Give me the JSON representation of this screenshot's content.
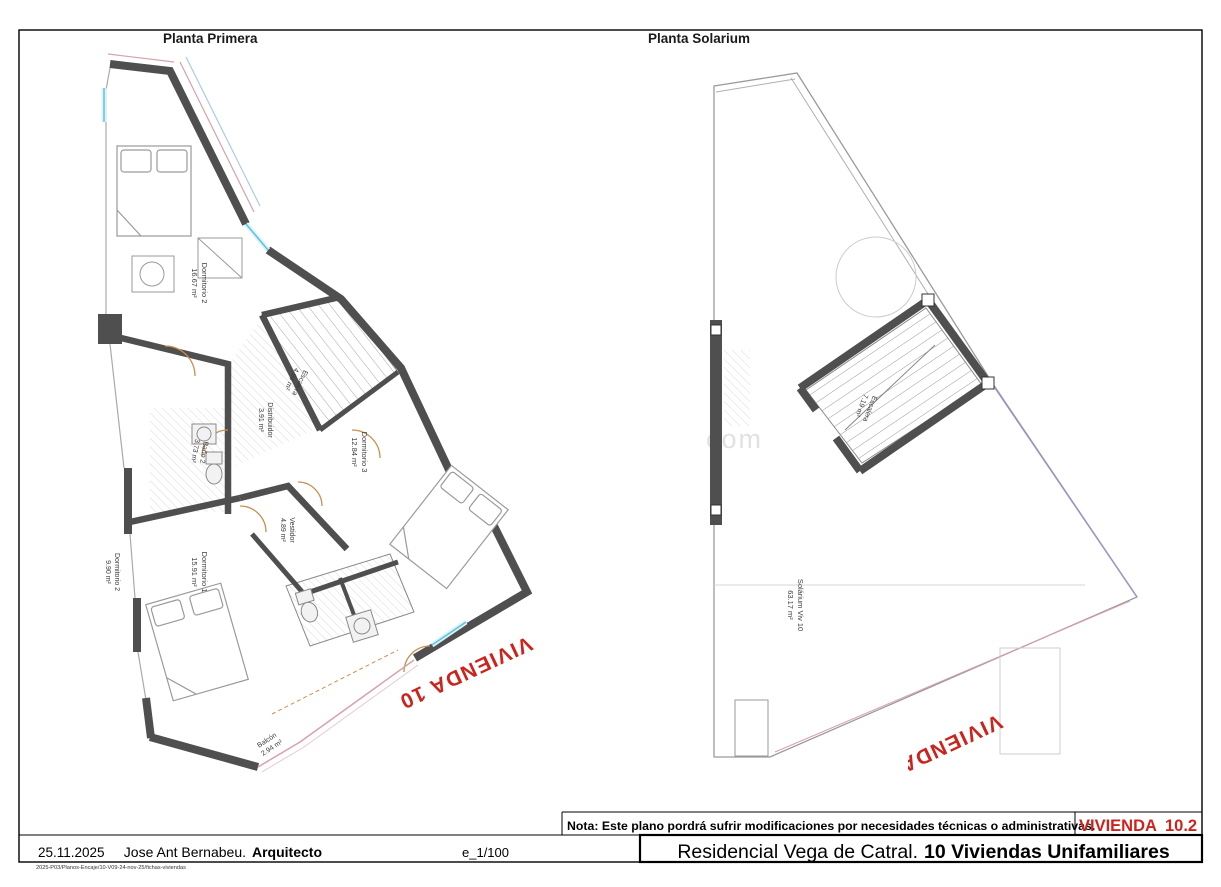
{
  "header": {
    "plan1_title": "Planta Primera",
    "plan2_title": "Planta Solarium"
  },
  "plan1": {
    "stamp": "VIVIENDA 10",
    "rooms": [
      {
        "name": "Dormitorio 2",
        "area": "16.67 m²"
      },
      {
        "name": "Escalera",
        "area": "4.94 m²"
      },
      {
        "name": "Distribuidor",
        "area": "3.91 m²"
      },
      {
        "name": "Baño 2",
        "area": "3.73 m²"
      },
      {
        "name": "Dormitorio 3",
        "area": "12.84 m²"
      },
      {
        "name": "Vestidor",
        "area": "4.89 m²"
      },
      {
        "name": "Dormitorio 1",
        "area": "15.91 m²"
      },
      {
        "name": "Dormitorio 2",
        "area": "9.90 m²"
      },
      {
        "name": "Balcón",
        "area": "2.94 m²"
      }
    ]
  },
  "plan2": {
    "stamp": "VIVIENDA 10",
    "rooms": [
      {
        "name": "Escalera",
        "area": "7.19 m²"
      },
      {
        "name": "Solárium Viv 10",
        "area": "63.17 m²"
      }
    ]
  },
  "note": {
    "text": "Nota: Este plano pordrá sufrir modificaciones por necesidades técnicas o administrativas.",
    "vivienda_label": "VIVIENDA",
    "vivienda_number": "10.2"
  },
  "title_block": {
    "date": "25.11.2025",
    "architect_name": "Jose Ant Bernabeu.",
    "architect_role": "Arquitecto",
    "scale": "e_1/100",
    "project_name": "Residencial Vega de Catral.",
    "project_emphasis": "10 Viviendas Unifamiliares"
  },
  "footer": {
    "file_reference": "2025-P03/Planos-Encaje/10-V09-24-nov-25/fichas-viviendas"
  },
  "watermark": "com",
  "colors": {
    "wall": "#4f4f4f",
    "stamp_red": "#cc241c",
    "window_cyan": "#58c5dd",
    "door_orange": "#c98f4e",
    "railing_pink": "#d9a0ac",
    "boundary_purple": "#9d93c8"
  }
}
